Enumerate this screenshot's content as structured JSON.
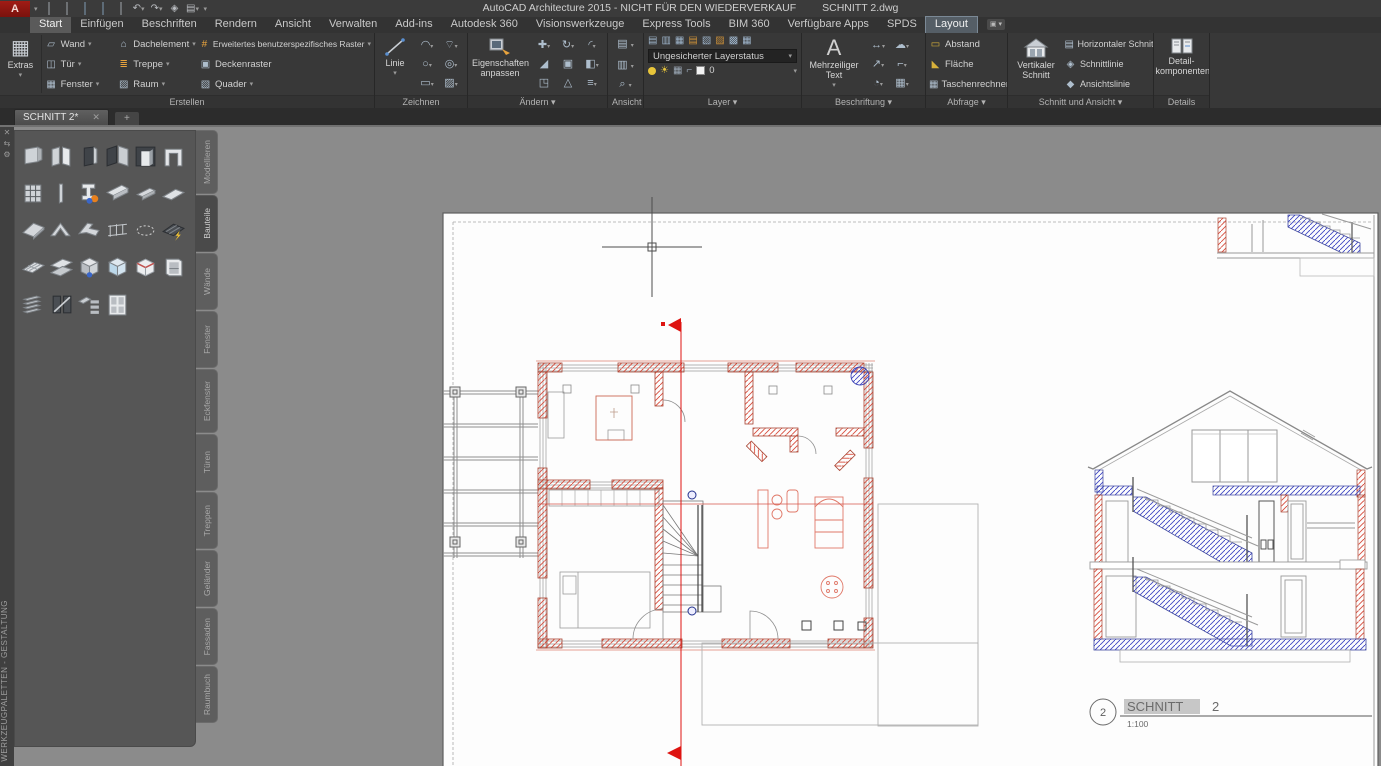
{
  "titlebar": {
    "app_title": "AutoCAD Architecture 2015 - NICHT FÜR DEN WIEDERVERKAUF",
    "doc_name": "SCHNITT 2.dwg"
  },
  "tabs": [
    "Start",
    "Einfügen",
    "Beschriften",
    "Rendern",
    "Ansicht",
    "Verwalten",
    "Add-ins",
    "Autodesk 360",
    "Visionswerkzeuge",
    "Express Tools",
    "BIM 360",
    "Verfügbare Apps",
    "SPDS",
    "Layout"
  ],
  "ribbon": {
    "extras": "Extras",
    "erstellen": {
      "label": "Erstellen",
      "wand": "Wand",
      "tuer": "Tür",
      "fenster": "Fenster",
      "dachelement": "Dachelement",
      "treppe": "Treppe",
      "raum": "Raum",
      "raster": "Erweitertes benutzerspezifisches Raster",
      "deckenraster": "Deckenraster",
      "quader": "Quader"
    },
    "zeichnen": {
      "label": "Zeichnen",
      "linie": "Linie"
    },
    "aendern": {
      "label": "Ändern",
      "eigenschaften": "Eigenschaften anpassen"
    },
    "ansicht": {
      "label": "Ansicht"
    },
    "layer": {
      "label": "Layer",
      "status": "Ungesicherter Layerstatus",
      "current": "0"
    },
    "beschriftung": {
      "label": "Beschriftung",
      "mtext": "Mehrzeiliger Text"
    },
    "abfrage": {
      "label": "Abfrage",
      "abstand": "Abstand",
      "flaeche": "Fläche",
      "rechner": "Taschenrechner"
    },
    "schnitt": {
      "label": "Schnitt und Ansicht",
      "vertikal": "Vertikaler Schnitt",
      "horizontal": "Horizontaler Schnitt",
      "schnittlinie": "Schnittlinie",
      "ansichtslinie": "Ansichtslinie"
    },
    "details": {
      "label": "Details",
      "big": "Detail-komponenten"
    }
  },
  "file_tabs": {
    "active": "SCHNITT 2*",
    "close": "✕",
    "new_tab": "+"
  },
  "palette": {
    "title": "WERKZEUGPALETTEN - GESTALTUNG",
    "tabs": [
      "Modellieren",
      "Bauteile",
      "Wände",
      "Fenster",
      "Eckfenster",
      "Türen",
      "Treppen",
      "Geländer",
      "Fassaden",
      "Raumbuch"
    ],
    "active": "Bauteile"
  },
  "drawing": {
    "callout_number": "2",
    "callout_title": "SCHNITT",
    "callout_seq": "2",
    "scale": "1:100"
  },
  "colors": {
    "section_red": "#de1411",
    "wall_hatch_red": "#d84b3a",
    "slab_hatch_blue": "#3f46c5",
    "canvas_gray": "#8b8b8b",
    "paper_white": "#fdfdfd"
  }
}
